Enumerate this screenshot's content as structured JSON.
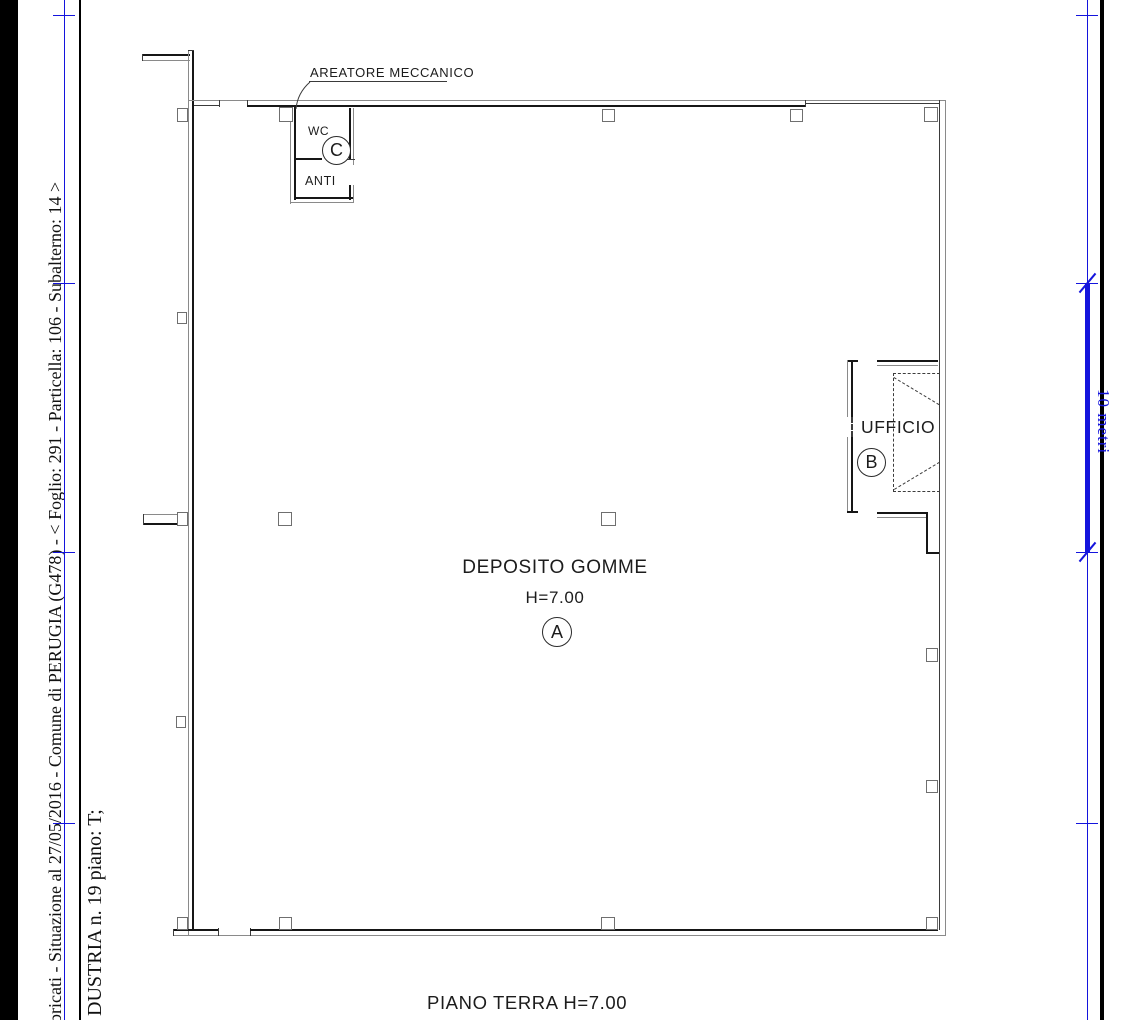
{
  "page": {
    "background": "#ffffff",
    "line_color": "#161616",
    "accent_blue": "#1414dd"
  },
  "margin": {
    "line1": "abbricati - Situazione al 27/05/2016 - Comune di PERUGIA (G478) - <  Foglio: 291 - Particella: 106 - Subalterno: 14 >",
    "line2": "DUSTRIA n. 19 piano: T;"
  },
  "scalebar": {
    "label": "10 metri"
  },
  "plan": {
    "areatore_label": "AREATORE MECCANICO",
    "wc_label": "WC",
    "wc_circle": "C",
    "anti_label": "ANTI",
    "ufficio_label": "UFFICIO",
    "ufficio_circle": "B",
    "deposito_label": "DEPOSITO GOMME",
    "deposito_height": "H=7.00",
    "deposito_circle": "A",
    "floor_label": "PIANO TERRA H=7.00"
  }
}
